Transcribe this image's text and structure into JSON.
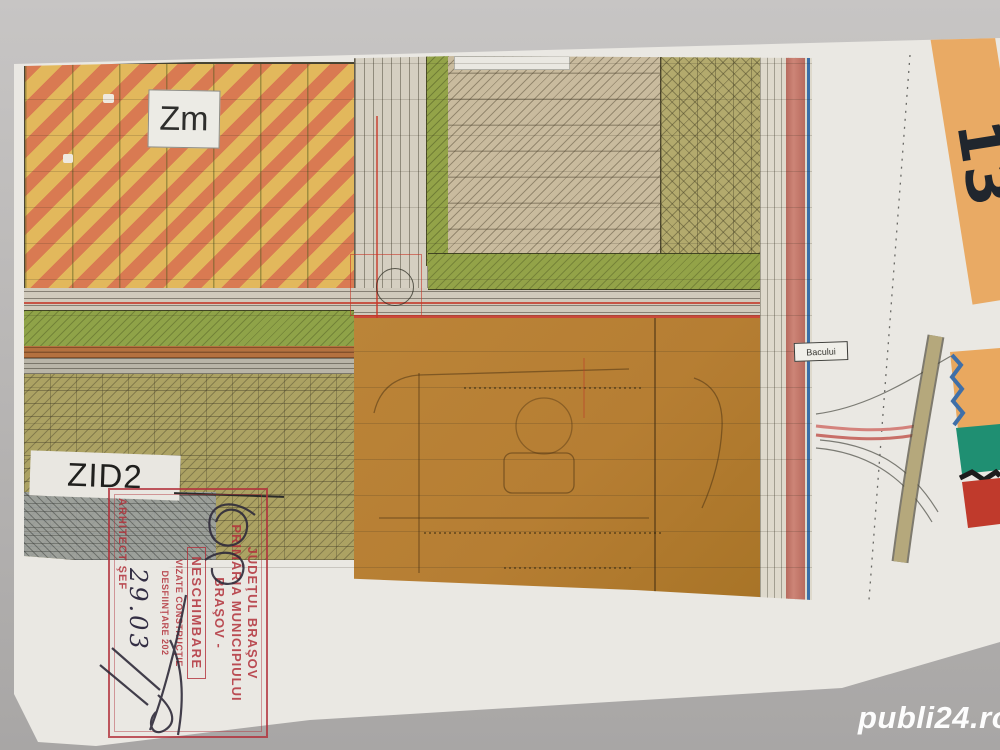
{
  "meta": {
    "description": "Photograph of a scanned municipal zoning plan sheet (PUG Brasov) lying on a gray surface",
    "colors": {
      "background_gray": "#b0aeae",
      "paper": "#eae8e3",
      "orange_stripe_a": "#d97a52",
      "orange_stripe_b": "#e2b85c",
      "green_band": "#8fa348",
      "olive_zone": "#aca263",
      "tan_hatched_zone": "#c9bb9e",
      "brown_parcel_zone": "#b67e33",
      "road_gray": "#d0cabc",
      "salmon_road_edge": "#cd8577",
      "utility_blue": "#3a6ea8",
      "stamp_red": "#bf3e44",
      "adjacent_sheet_orange": "#e9aa64",
      "ink_dark": "#332e44"
    }
  },
  "map": {
    "labels": {
      "zone_mixed": "Zm",
      "zone_industrial": "ZID2",
      "street": "Bacului",
      "sheet_number": "13"
    }
  },
  "stamp": {
    "line1": "JUDEŢUL BRAŞOV",
    "line2": "PRIMĂRIA MUNICIPIULUI",
    "line3": "BRAŞOV -",
    "neschimbare": "NESCHIMBARE",
    "small1": "VIZATE  CONSTRUCŢIE",
    "small2": "DESFIINŢARE  202",
    "arhitect": "ARHITECT ŞEF",
    "handwritten_date": "29.03"
  },
  "watermark": {
    "text": "publi24.ro"
  }
}
